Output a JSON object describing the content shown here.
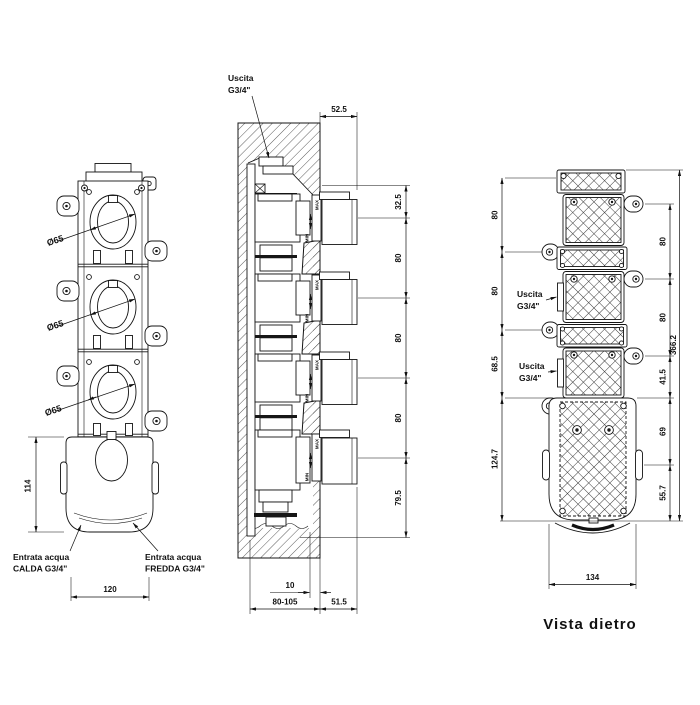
{
  "front_view": {
    "diameter_label": "Ø65",
    "dim_body_height": "114",
    "dim_body_width": "120",
    "inlet_hot": [
      "Entrata acqua",
      "CALDA G3/4\""
    ],
    "inlet_cold": [
      "Entrata acqua",
      "FREDDA G3/4\""
    ]
  },
  "section_view": {
    "outlet_label": [
      "Uscita",
      "G3/4\""
    ],
    "dim_knob_depth": "52.5",
    "dim_chain": [
      "32.5",
      "80",
      "80",
      "80",
      "79.5"
    ],
    "dim_plate_thickness": "10",
    "dim_recess_depth": "80-105",
    "dim_trim_depth": "51.5",
    "max_label": "MAX",
    "min_label": "MIN"
  },
  "rear_view": {
    "outlet_label_1": [
      "Uscita",
      "G3/4\""
    ],
    "outlet_label_2": [
      "Uscita",
      "G3/4\""
    ],
    "dims_left": [
      "80",
      "80",
      "68.5",
      "124.7"
    ],
    "dims_right": [
      "80",
      "80",
      "41.5",
      "69",
      "55.7"
    ],
    "dim_total_height": "366.2",
    "dim_body_width": "134",
    "caption": "Vista dietro"
  }
}
